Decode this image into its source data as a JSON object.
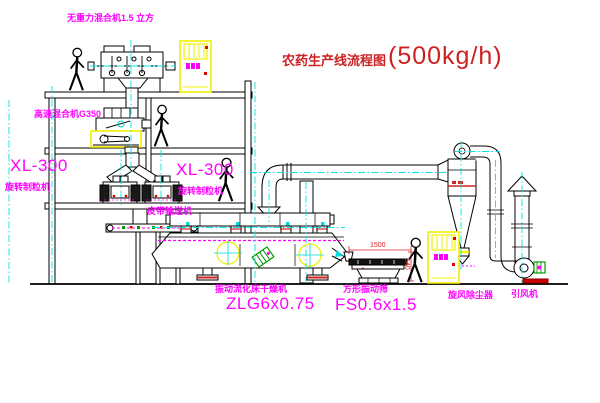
{
  "title": {
    "name": "农药生产线流程图",
    "capacity": "(500kg/h)"
  },
  "equipment_labels": {
    "gravity_mixer": "无重力混合机1.5 立方",
    "high_speed_mixer": "高速混合机G350",
    "granulator_left_model": "XL-300",
    "granulator_left_name": "旋转制粒机",
    "granulator_right_model": "XL-300",
    "granulator_right_name": "旋转制粒机",
    "belt_conveyor": "皮带输送机",
    "fluid_bed_dryer_name": "振动流化床干燥机",
    "fluid_bed_dryer_model": "ZLG6x0.75",
    "vibrating_screen_name": "方形振动筛",
    "vibrating_screen_model": "FS0.6x1.5",
    "cyclone": "旋风除尘器",
    "induced_draft_fan": "引风机"
  },
  "dimensions": {
    "screen_length": "1500",
    "screen_height": "540"
  },
  "colors": {
    "label_magenta": "#FF00FF",
    "title_red": "#CC2222",
    "centerline_cyan": "#00FFFF",
    "highlight_yellow": "#FFFF00",
    "dimension_red": "#DD2222",
    "line_black": "#000000"
  }
}
